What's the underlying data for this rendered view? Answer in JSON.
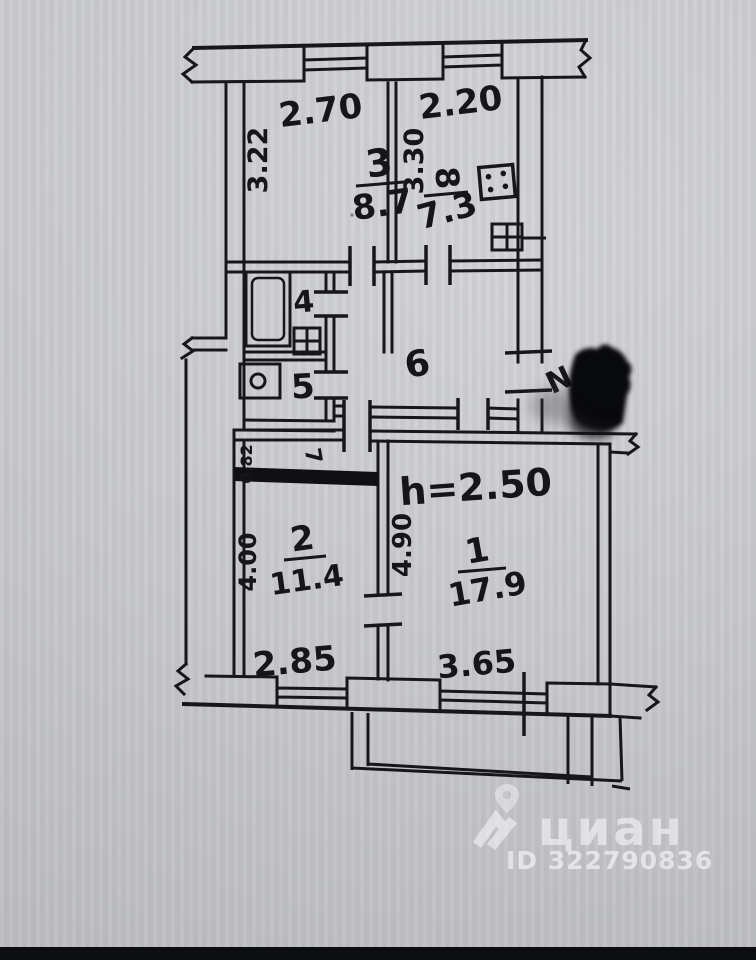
{
  "floorplan": {
    "ceiling_height": "h=2.50",
    "entry_mark": "N",
    "rooms": [
      {
        "name": "living-room-3",
        "number": "3",
        "area": "8.7",
        "width": "2.70",
        "depth": "3.22"
      },
      {
        "name": "kitchen",
        "number": "8",
        "area": "7.3",
        "width": "2.20",
        "depth": "3.30"
      },
      {
        "name": "bathroom",
        "number": "4"
      },
      {
        "name": "wc",
        "number": "5"
      },
      {
        "name": "hallway",
        "number": "6"
      },
      {
        "name": "closet",
        "number": "7",
        "depth": "0.82"
      },
      {
        "name": "living-room-2",
        "number": "2",
        "area": "11.4",
        "depth": "4.00",
        "width": "2.85"
      },
      {
        "name": "living-room-1",
        "number": "1",
        "area": "17.9",
        "depth": "4.90",
        "width": "3.65"
      }
    ]
  },
  "watermark": {
    "brand": "циан",
    "listing_id": "ID 322790836"
  },
  "colors": {
    "ink": "#17171b",
    "paper": "#cdced2",
    "redaction": "#08090b",
    "watermark_white": "#ffffff"
  }
}
